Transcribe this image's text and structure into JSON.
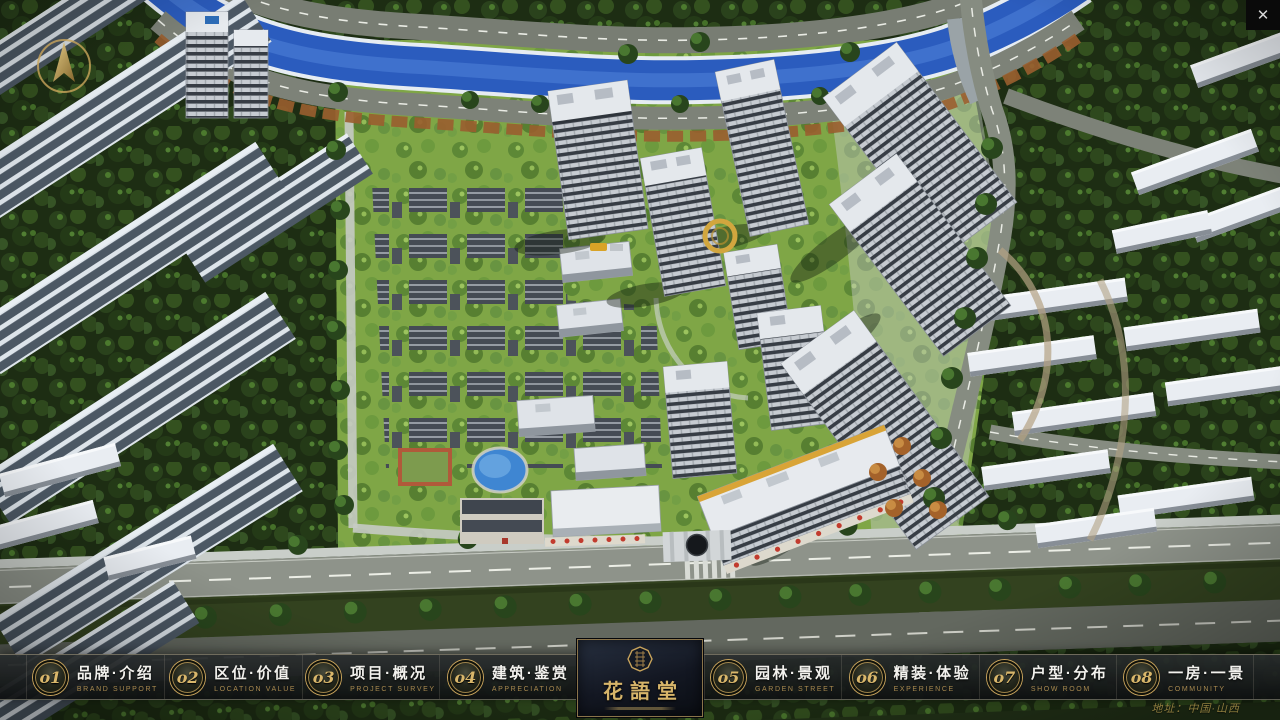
{
  "theme": {
    "accent_gold": "#c9a45c",
    "nav_background": "rgba(18,22,24,0.9)",
    "nav_text": "#f2f1ed",
    "nav_english_text": "#a8894f",
    "logo_gold": "#d7b56a",
    "address_gold": "#8f7d3e",
    "river_blue": "#2b5cbe",
    "lawn_green": "#7fa646"
  },
  "icons": {
    "close_glyph": "✕",
    "compass": "north-arrow-compass",
    "logo_seal": "octagonal-seal"
  },
  "navbar": {
    "items": [
      {
        "id": "brand-intro",
        "num": "o1",
        "zh": "品牌·介绍",
        "en": "BRAND SUPPORT"
      },
      {
        "id": "location-value",
        "num": "o2",
        "zh": "区位·价值",
        "en": "LOCATION VALUE"
      },
      {
        "id": "project-survey",
        "num": "o3",
        "zh": "项目·概况",
        "en": "PROJECT SURVEY"
      },
      {
        "id": "architecture",
        "num": "o4",
        "zh": "建筑·鉴赏",
        "en": "APPRECIATION"
      },
      {
        "id": "garden-landscape",
        "num": "o5",
        "zh": "园林·景观",
        "en": "GARDEN STREET"
      },
      {
        "id": "deco-experience",
        "num": "o6",
        "zh": "精装·体验",
        "en": "EXPERIENCE"
      },
      {
        "id": "unit-distribution",
        "num": "o7",
        "zh": "户型·分布",
        "en": "SHOW ROOM"
      },
      {
        "id": "one-room-one-view",
        "num": "o8",
        "zh": "一房·一景",
        "en": "COMMUNITY"
      }
    ],
    "logo": {
      "title": "花語堂"
    },
    "address": "地址：中国·山西"
  }
}
